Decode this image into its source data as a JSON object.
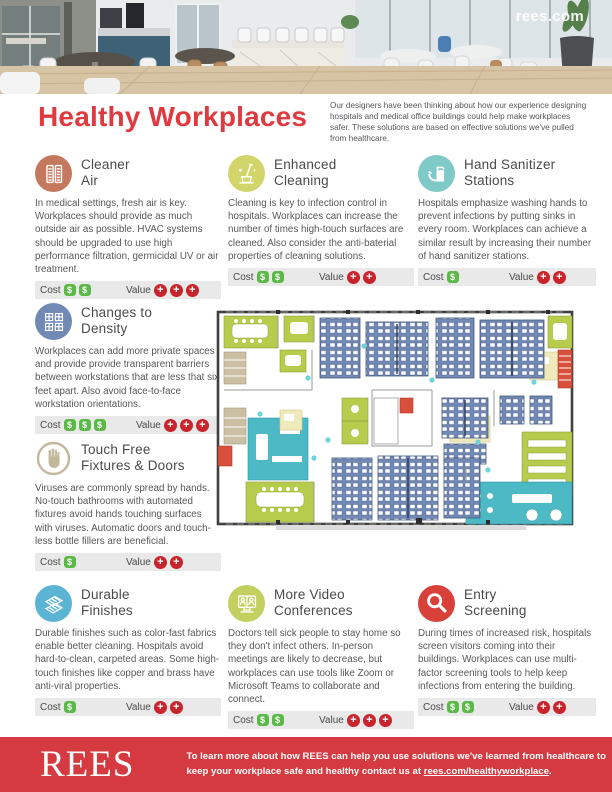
{
  "header": {
    "watermark": "rees.com"
  },
  "intro": {
    "title": "Healthy Workplaces",
    "paragraph": "Our designers have been thinking about how our experience designing hospitals and medical office buildings could help make workplaces safer. These solutions are based on effective solutions we've pulled from healthcare."
  },
  "labels": {
    "cost": "Cost",
    "value": "Value",
    "dollar": "$",
    "plus": "+"
  },
  "sections": [
    {
      "id": "cleaner-air",
      "icon": "air-filter-icon",
      "icon_color": "#c4795f",
      "title_lines": [
        "Cleaner",
        "Air"
      ],
      "body": "In medical settings, fresh air is key. Workplaces should provide as much outside air as possible. HVAC systems should be upgraded to use high performance filtration, germicidal UV or air treatment.",
      "cost": 2,
      "value": 3
    },
    {
      "id": "enhanced-cleaning",
      "icon": "cleaning-icon",
      "icon_color": "#d2d66a",
      "title_lines": [
        "Enhanced",
        "Cleaning"
      ],
      "body": "Cleaning is key to infection control in hospitals. Workplaces can increase the number of times high-touch surfaces are cleaned. Also consider the anti-baterial properties of cleaning solutions.",
      "cost": 2,
      "value": 2
    },
    {
      "id": "hand-sanitizer-stations",
      "icon": "sanitizer-icon",
      "icon_color": "#7fc9c6",
      "title_lines": [
        "Hand Sanitizer",
        "Stations"
      ],
      "body": "Hospitals emphasize washing hands to prevent infections by putting sinks in every room. Workplaces can achieve a similar result by increasing their number of hand sanitizer stations.",
      "cost": 1,
      "value": 2
    },
    {
      "id": "changes-to-density",
      "icon": "workstations-icon",
      "icon_color": "#7189b5",
      "title_lines": [
        "Changes to",
        "Density"
      ],
      "body": "Workplaces can add more private spaces and provide provide transparent barriers between workstations that are less that six feet apart. Also avoid face-to-face workstation orientations.",
      "cost": 3,
      "value": 3
    },
    {
      "id": "touch-free-fixtures-doors",
      "icon": "no-touch-icon",
      "icon_color": "#c3b79c",
      "title_lines": [
        "Touch Free",
        "Fixtures & Doors"
      ],
      "body": "Viruses are commonly spread by hands. No-touch bathrooms with automated fixtures avoid hands touching surfaces with viruses. Automatic doors and touch-less bottle fillers are beneficial.",
      "cost": 1,
      "value": 2
    },
    {
      "id": "durable-finishes",
      "icon": "fabric-icon",
      "icon_color": "#5cb4d4",
      "title_lines": [
        "Durable",
        "Finishes"
      ],
      "body": "Durable finishes such as color-fast fabrics enable better cleaning. Hospitals avoid hard-to-clean, carpeted areas. Some high-touch finishes like copper and brass have anti-viral properties.",
      "cost": 1,
      "value": 2
    },
    {
      "id": "more-video-conferences",
      "icon": "video-conference-icon",
      "icon_color": "#c3cf5f",
      "title_lines": [
        "More Video",
        "Conferences"
      ],
      "body": "Doctors tell sick people to stay home so they don't infect others. In-person meetings are likely to decrease, but workplaces can use tools like Zoom or Microsoft Teams to collaborate and connect.",
      "cost": 2,
      "value": 3
    },
    {
      "id": "entry-screening",
      "icon": "magnifier-icon",
      "icon_color": "#d8403a",
      "title_lines": [
        "Entry",
        "Screening"
      ],
      "body": "During times of increased risk, hospitals screen visitors coming into their buildings. Workplaces can use multi-factor screening tools to help keep infections from entering the building.",
      "cost": 2,
      "value": 2
    }
  ],
  "footer": {
    "logo": "REES",
    "message_line1": "To learn more about how REES can help you use solutions we've learned from healthcare to",
    "message_line2_prefix": "keep your workplace safe and healthy contact us at ",
    "link": "rees.com/healthyworkplace",
    "message_suffix": "."
  },
  "colors": {
    "accent_red": "#e0393e",
    "footer_red": "#d43a40",
    "cost_green": "#5bb947",
    "value_red": "#c9232b",
    "bar_bg": "#e9e9e9",
    "plan_blue": "#7189b5",
    "plan_green": "#b7cb4d",
    "plan_teal": "#4db9c4",
    "plan_yellow": "#efeabc",
    "plan_red": "#d8503c",
    "plan_tan": "#cbbfa4"
  }
}
